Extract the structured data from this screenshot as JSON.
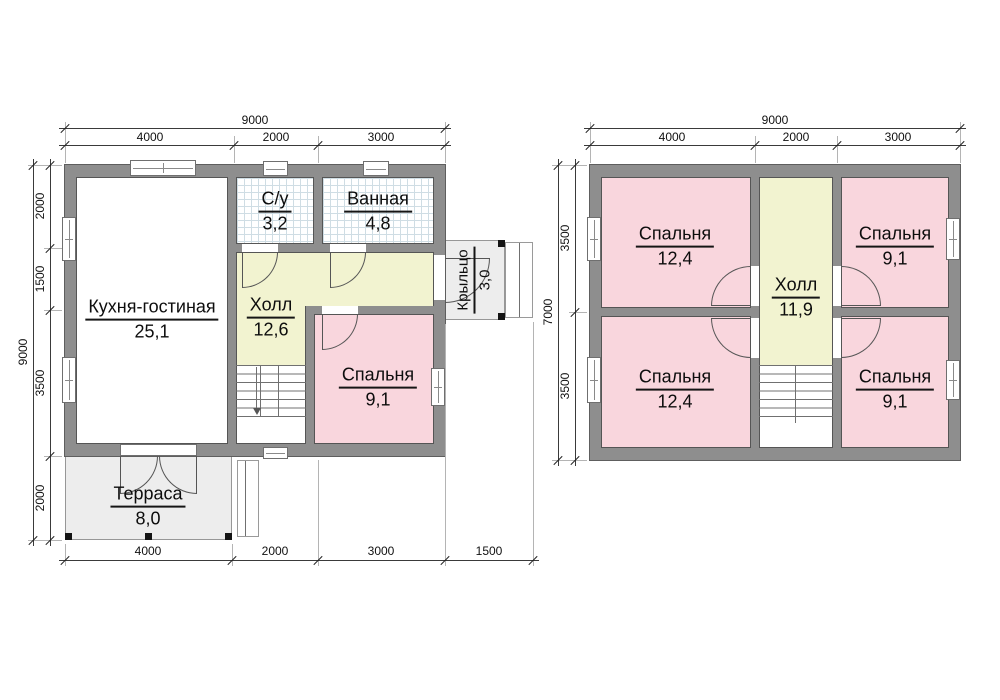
{
  "floor1": {
    "kitchen": {
      "name": "Кухня-гостиная",
      "area": "25,1"
    },
    "wc": {
      "name": "С/у",
      "area": "3,2"
    },
    "bath": {
      "name": "Ванная",
      "area": "4,8"
    },
    "hall": {
      "name": "Холл",
      "area": "12,6"
    },
    "bedroom": {
      "name": "Спальня",
      "area": "9,1"
    },
    "terrace": {
      "name": "Терраса",
      "area": "8,0"
    },
    "porch": {
      "name": "Крыльцо",
      "area": "3,0"
    },
    "dim_top_total": "9000",
    "dim_top": [
      "4000",
      "2000",
      "3000"
    ],
    "dim_left_total": "9000",
    "dim_left": [
      "2000",
      "1500",
      "3500",
      "2000"
    ],
    "dim_bottom": [
      "4000",
      "2000",
      "3000",
      "1500"
    ]
  },
  "floor2": {
    "bedroom_tl": {
      "name": "Спальня",
      "area": "12,4"
    },
    "bedroom_tr": {
      "name": "Спальня",
      "area": "9,1"
    },
    "hall": {
      "name": "Холл",
      "area": "11,9"
    },
    "bedroom_bl": {
      "name": "Спальня",
      "area": "12,4"
    },
    "bedroom_br": {
      "name": "Спальня",
      "area": "9,1"
    },
    "dim_top_total": "9000",
    "dim_top": [
      "4000",
      "2000",
      "3000"
    ],
    "dim_left_total": "7000",
    "dim_left": [
      "3500",
      "3500"
    ]
  },
  "colors": {
    "wall": "#8e8e8e",
    "room_pink": "#f9d6dd",
    "room_yellow": "#f2f3d0",
    "outdoor_gray": "#ededed"
  }
}
